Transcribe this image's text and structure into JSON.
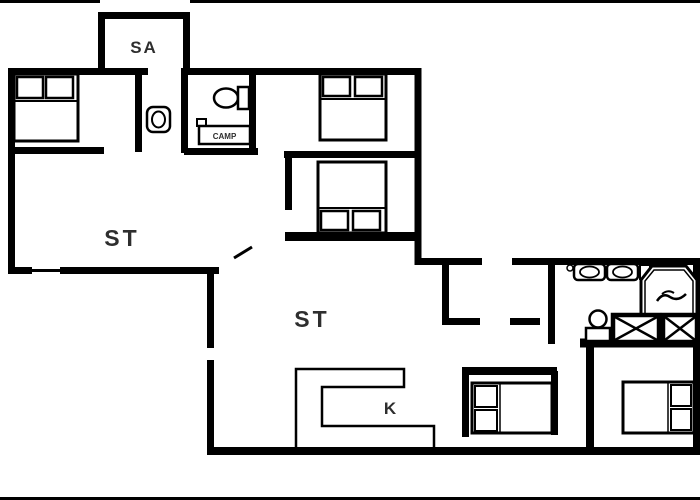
{
  "plan": {
    "labels": {
      "sauna": "SA",
      "living_room_upper": "ST",
      "living_room_lower": "ST",
      "kitchen": "K",
      "vanity": "CAMP"
    },
    "colors": {
      "wall": "#000000",
      "background": "#ffffff",
      "label": "#2e2e2e"
    },
    "icons": [
      "double-bed-icon",
      "toilet-icon",
      "washbasin-icon",
      "spa-tub-icon",
      "shower-cabinet-icon",
      "kitchen-counter-icon",
      "door-swing-icon"
    ]
  }
}
